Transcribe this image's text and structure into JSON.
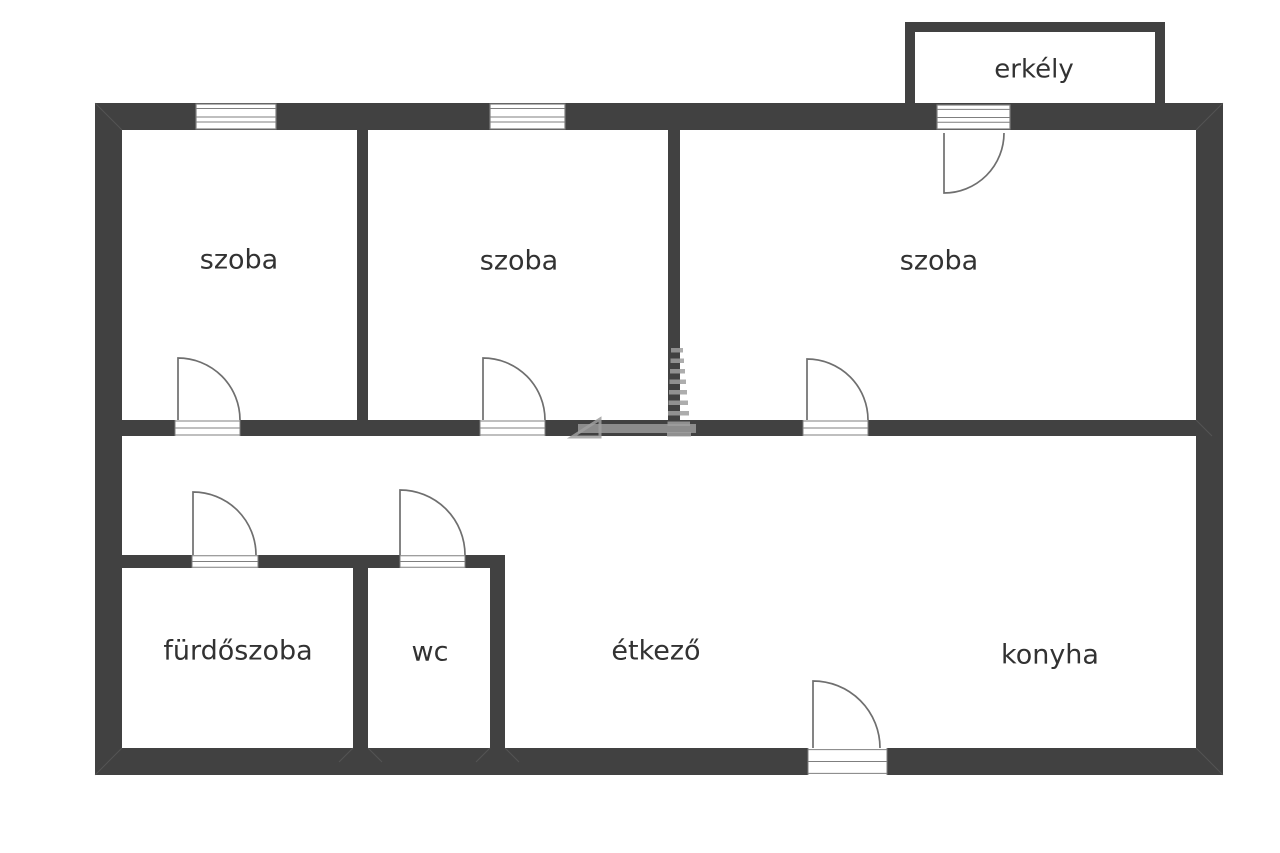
{
  "title": "floor-plan",
  "colors": {
    "background": "#ffffff",
    "wall": "#414141",
    "thin_line": "#7f7f7f",
    "label": "#323232",
    "watermark": "#9f9f9f",
    "mitre": "#6b6b6b"
  },
  "rooms": [
    {
      "id": "room-szoba-1",
      "label": "szoba",
      "x": 239,
      "y": 261,
      "size": 27
    },
    {
      "id": "room-szoba-2",
      "label": "szoba",
      "x": 519,
      "y": 262,
      "size": 27
    },
    {
      "id": "room-szoba-3",
      "label": "szoba",
      "x": 939,
      "y": 262,
      "size": 27
    },
    {
      "id": "room-erkely",
      "label": "erkély",
      "x": 1034,
      "y": 70,
      "size": 26
    },
    {
      "id": "room-furdoszoba",
      "label": "fürdőszoba",
      "x": 238,
      "y": 652,
      "size": 27
    },
    {
      "id": "room-wc",
      "label": "wc",
      "x": 430,
      "y": 653,
      "size": 27
    },
    {
      "id": "room-etkezo",
      "label": "étkező",
      "x": 656,
      "y": 652,
      "size": 27
    },
    {
      "id": "room-konyha",
      "label": "konyha",
      "x": 1050,
      "y": 656,
      "size": 27
    }
  ],
  "walls": [
    {
      "id": "outer-top-wall",
      "x": 95,
      "y": 103,
      "w": 1128,
      "h": 27
    },
    {
      "id": "outer-left-wall",
      "x": 95,
      "y": 103,
      "w": 27,
      "h": 672
    },
    {
      "id": "outer-right-wall",
      "x": 1196,
      "y": 103,
      "w": 27,
      "h": 672
    },
    {
      "id": "outer-bottom-wall",
      "x": 95,
      "y": 748,
      "w": 1128,
      "h": 27
    },
    {
      "id": "balcony-left-wall",
      "x": 905,
      "y": 22,
      "w": 10,
      "h": 81
    },
    {
      "id": "balcony-top-wall",
      "x": 905,
      "y": 22,
      "w": 260,
      "h": 10
    },
    {
      "id": "balcony-right-wall",
      "x": 1155,
      "y": 22,
      "w": 10,
      "h": 81
    },
    {
      "id": "divider-szoba1-szoba2",
      "x": 357,
      "y": 130,
      "w": 11,
      "h": 306
    },
    {
      "id": "divider-szoba2-szoba3",
      "x": 668,
      "y": 130,
      "w": 12,
      "h": 306
    },
    {
      "id": "corridor-wall",
      "x": 122,
      "y": 420,
      "w": 1074,
      "h": 16
    },
    {
      "id": "bathroom-top-wall",
      "x": 122,
      "y": 555,
      "w": 383,
      "h": 13
    },
    {
      "id": "bathroom-wc-divider",
      "x": 353,
      "y": 555,
      "w": 15,
      "h": 193
    },
    {
      "id": "wc-right-wall",
      "x": 490,
      "y": 555,
      "w": 15,
      "h": 193
    }
  ],
  "mitres": [
    {
      "id": "mitre-top-left",
      "x1": 95,
      "y1": 103,
      "x2": 122,
      "y2": 130
    },
    {
      "id": "mitre-top-right",
      "x1": 1223,
      "y1": 103,
      "x2": 1196,
      "y2": 130
    },
    {
      "id": "mitre-bottom-left",
      "x1": 95,
      "y1": 775,
      "x2": 122,
      "y2": 748
    },
    {
      "id": "mitre-bottom-right",
      "x1": 1223,
      "y1": 775,
      "x2": 1196,
      "y2": 748
    },
    {
      "id": "mitre-divider-bl",
      "x1": 353,
      "y1": 748,
      "x2": 339,
      "y2": 762
    },
    {
      "id": "mitre-divider-br",
      "x1": 368,
      "y1": 748,
      "x2": 382,
      "y2": 762
    },
    {
      "id": "mitre-wc-bl",
      "x1": 490,
      "y1": 748,
      "x2": 476,
      "y2": 762
    },
    {
      "id": "mitre-wc-br",
      "x1": 505,
      "y1": 748,
      "x2": 519,
      "y2": 762
    },
    {
      "id": "mitre-corridor-r",
      "x1": 1196,
      "y1": 420,
      "x2": 1212,
      "y2": 436
    }
  ],
  "windows": [
    {
      "id": "window-szoba-1",
      "x": 196,
      "y": 104,
      "w": 80,
      "h": 25
    },
    {
      "id": "window-szoba-2",
      "x": 490,
      "y": 104,
      "w": 75,
      "h": 25
    },
    {
      "id": "window-balcony-door",
      "x": 937,
      "y": 105,
      "w": 73,
      "h": 24
    }
  ],
  "door_openings": [
    {
      "id": "opening-szoba-1-door",
      "x": 175,
      "y": 420,
      "w": 65,
      "h": 16
    },
    {
      "id": "opening-szoba-2-door",
      "x": 480,
      "y": 420,
      "w": 65,
      "h": 16
    },
    {
      "id": "opening-szoba-3-door",
      "x": 803,
      "y": 420,
      "w": 65,
      "h": 16
    },
    {
      "id": "opening-bathroom-door",
      "x": 192,
      "y": 555,
      "w": 66,
      "h": 13
    },
    {
      "id": "opening-wc-door",
      "x": 400,
      "y": 555,
      "w": 65,
      "h": 13
    },
    {
      "id": "opening-entrance-door",
      "x": 808,
      "y": 748,
      "w": 79,
      "h": 27
    }
  ],
  "doors": [
    {
      "id": "szoba-1-door",
      "hinge": [
        178,
        420
      ],
      "r": 62,
      "panel_deg": -90,
      "end_deg": 0,
      "sweep": 1
    },
    {
      "id": "szoba-2-door",
      "hinge": [
        483,
        420
      ],
      "r": 62,
      "panel_deg": -90,
      "end_deg": 0,
      "sweep": 1
    },
    {
      "id": "szoba-3-door",
      "hinge": [
        807,
        420
      ],
      "r": 61,
      "panel_deg": -90,
      "end_deg": 0,
      "sweep": 1
    },
    {
      "id": "balcony-door",
      "hinge": [
        944,
        133
      ],
      "r": 60,
      "panel_deg": 90,
      "end_deg": 0,
      "sweep": 0
    },
    {
      "id": "bathroom-door",
      "hinge": [
        193,
        555
      ],
      "r": 63,
      "panel_deg": -90,
      "end_deg": 0,
      "sweep": 1
    },
    {
      "id": "wc-door",
      "hinge": [
        400,
        555
      ],
      "r": 65,
      "panel_deg": -90,
      "end_deg": 0,
      "sweep": 1
    },
    {
      "id": "entrance-door",
      "hinge": [
        813,
        748
      ],
      "r": 67,
      "panel_deg": -90,
      "end_deg": 0,
      "sweep": 1
    }
  ],
  "watermark": {
    "id": "watermark-logo",
    "bars": [
      {
        "x": 671.0,
        "y": 348.0,
        "w": 12.0,
        "h": 4.5
      },
      {
        "x": 670.5,
        "y": 358.5,
        "w": 13.5,
        "h": 4.5
      },
      {
        "x": 670.0,
        "y": 369.0,
        "w": 15.0,
        "h": 4.5
      },
      {
        "x": 669.5,
        "y": 379.5,
        "w": 16.5,
        "h": 4.5
      },
      {
        "x": 669.0,
        "y": 390.0,
        "w": 18.0,
        "h": 4.5
      },
      {
        "x": 668.5,
        "y": 400.5,
        "w": 19.5,
        "h": 4.5
      },
      {
        "x": 668.0,
        "y": 411.0,
        "w": 21.0,
        "h": 4.5
      },
      {
        "x": 667.5,
        "y": 421.5,
        "w": 22.5,
        "h": 4.5
      },
      {
        "x": 667.0,
        "y": 432.0,
        "w": 24.0,
        "h": 4.5
      }
    ],
    "baseline": {
      "x": 578,
      "y": 424,
      "w": 118,
      "h": 9
    },
    "flag": {
      "points": "572,437 600,419 600,437"
    }
  }
}
